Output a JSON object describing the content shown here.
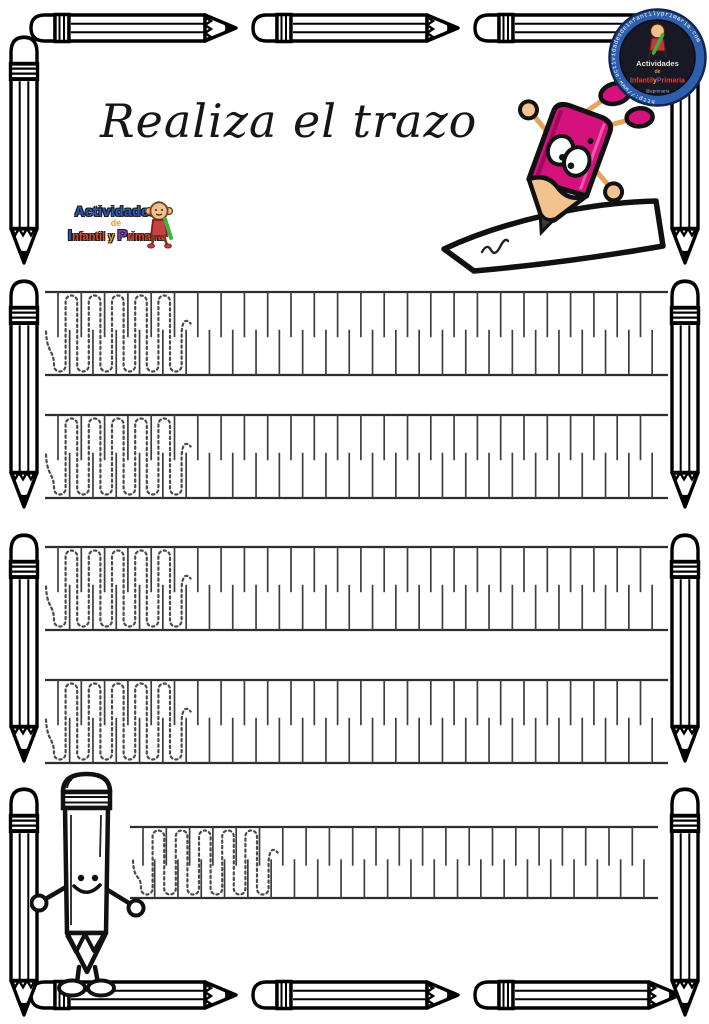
{
  "page": {
    "background": "#ffffff",
    "border_style": "cartoon pencil frame",
    "border_outline_color": "#000000"
  },
  "title": {
    "text": "Realiza el trazo"
  },
  "logo": {
    "actividades": "Actividades",
    "de": "de",
    "infantil_i": "I",
    "infantil_rest": "nfantil",
    "y": "y",
    "primaria_p": "P",
    "primaria_rest": "rimaria",
    "colors": {
      "actividades": "#2a57c0",
      "de": "#f59a20",
      "capital_i": "#2a50b0",
      "capital_p": "#7b3fae",
      "words": "#e04828"
    }
  },
  "badge": {
    "url": "http://www.actividadesdeinfantilyprimaria.com",
    "actividades": "Actividades",
    "de": "de",
    "infantil_i": "I",
    "infantil_rest": "nfantil",
    "y": "y",
    "primaria_p": "P",
    "primaria_rest": "rimaria",
    "handle": "@eprimaria",
    "ring_color": "#2e5fae",
    "inner_color": "#191926",
    "url_text_color": "#ffffff"
  },
  "illustrations": {
    "top_right": "pink-pencil-mascot-drawing-on-paper",
    "bottom_left": "smiling-pencil-mascot",
    "logo_mascot": "monkey-mascot",
    "badge_mascot": "kid-with-green-pencil-mascot",
    "frame": "black-and-white-cartoon-pencil-border",
    "pencil_pink": "#d4117c",
    "pencil_wood": "#f2c28f",
    "pencil_graphite": "#3a3a3a"
  },
  "tracing": {
    "pattern": "dotted vertical loop wave to trace between alternating tick guides",
    "style": {
      "line_color": "#2e2e2e",
      "line_width": 2.2,
      "tick_color": "#3e3e3e",
      "tick_width": 1.7,
      "tick_gap": 11.65,
      "first_tick_offset": 13,
      "tick_len_frac": 0.545,
      "wave_color": "#4b4b4b",
      "wave_width": 2.2,
      "wave_dash": "2.3 3.2",
      "wave_r": 5.8
    },
    "rows": [
      {
        "x": 45,
        "w": 623,
        "top": 292,
        "bottom": 375,
        "wave_x": 54,
        "peaks": 5
      },
      {
        "x": 45,
        "w": 623,
        "top": 415,
        "bottom": 498,
        "wave_x": 54,
        "peaks": 5
      },
      {
        "x": 45,
        "w": 623,
        "top": 547,
        "bottom": 630,
        "wave_x": 54,
        "peaks": 5
      },
      {
        "x": 45,
        "w": 623,
        "top": 680,
        "bottom": 763,
        "wave_x": 54,
        "peaks": 5
      },
      {
        "x": 130,
        "w": 528,
        "top": 827,
        "bottom": 898,
        "wave_x": 141,
        "peaks": 5
      }
    ]
  }
}
